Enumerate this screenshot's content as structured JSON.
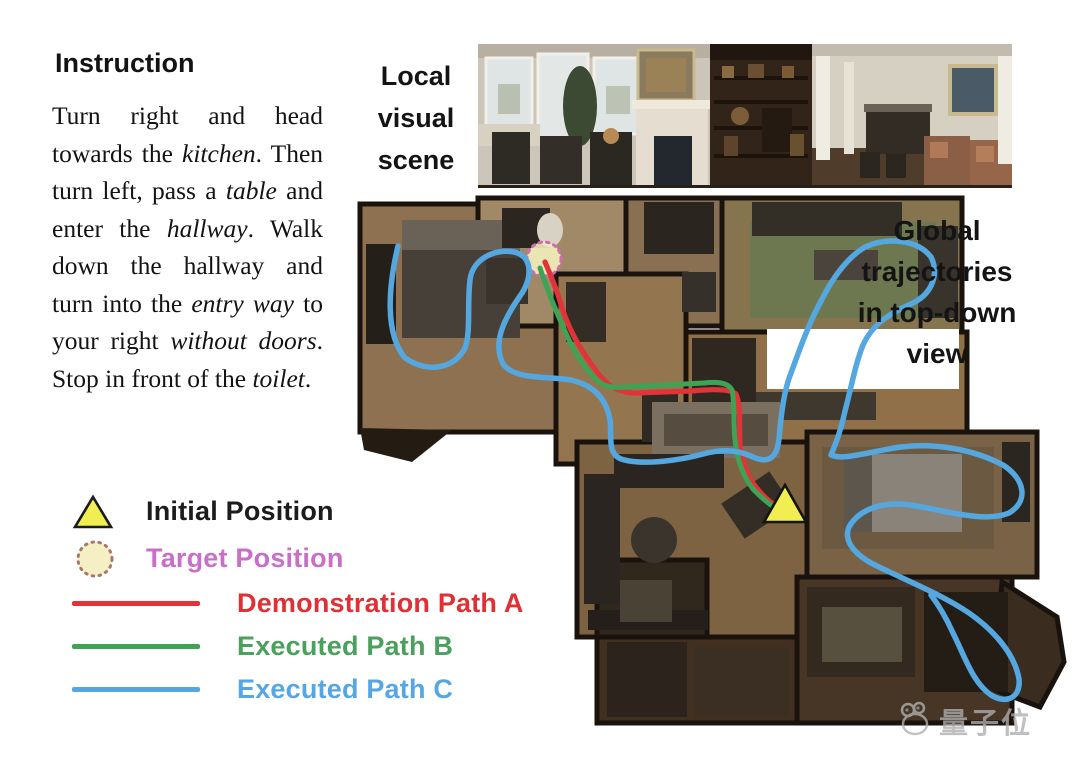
{
  "figure": {
    "instruction": {
      "heading": "Instruction",
      "full_text": "Turn right and head towards the kitchen. Then turn left, pass a table and enter the hallway. Walk down the hallway and turn into the entry way to your right without doors. Stop in front of the toilet.",
      "segments": [
        {
          "text": "Turn right and head towards the ",
          "italic": false
        },
        {
          "text": "kitchen",
          "italic": true
        },
        {
          "text": ". Then turn left, pass a ",
          "italic": false
        },
        {
          "text": "table",
          "italic": true
        },
        {
          "text": " and enter the ",
          "italic": false
        },
        {
          "text": "hallway",
          "italic": true
        },
        {
          "text": ". Walk down the hallway and turn into the ",
          "italic": false
        },
        {
          "text": "entry way",
          "italic": true
        },
        {
          "text": " to your right ",
          "italic": false
        },
        {
          "text": "without doors",
          "italic": true
        },
        {
          "text": ". Stop in front of the ",
          "italic": false
        },
        {
          "text": "toilet",
          "italic": true
        },
        {
          "text": ".",
          "italic": false
        }
      ]
    },
    "local_scene_label": {
      "lines": [
        "Local",
        "visual",
        "scene"
      ]
    },
    "global_label": {
      "lines": [
        "Global",
        "trajectories",
        "in top-down",
        "view"
      ]
    },
    "legend": {
      "items": [
        {
          "label": "Initial Position",
          "marker": "triangle",
          "marker_color": "#f1ee52",
          "label_color": "#1c1c1c"
        },
        {
          "label": "Target Position",
          "marker": "dotted-circle",
          "marker_color": "#f5f0c4",
          "label_color": "#c96fc9"
        },
        {
          "label": "Demonstration Path A",
          "marker": "line",
          "marker_color": "#e13438",
          "label_color": "#e02f35"
        },
        {
          "label": "Executed Path B",
          "marker": "line",
          "marker_color": "#3da355",
          "label_color": "#4aa05c"
        },
        {
          "label": "Executed Path C",
          "marker": "line",
          "marker_color": "#55a7e0",
          "label_color": "#54a6e4"
        }
      ]
    },
    "map": {
      "initial_position_marker": "yellow-triangle",
      "target_position_marker": "dashed-yellow-circle",
      "paths": [
        "Demonstration Path A",
        "Executed Path B",
        "Executed Path C"
      ]
    },
    "watermark": {
      "text": "量子位"
    }
  }
}
